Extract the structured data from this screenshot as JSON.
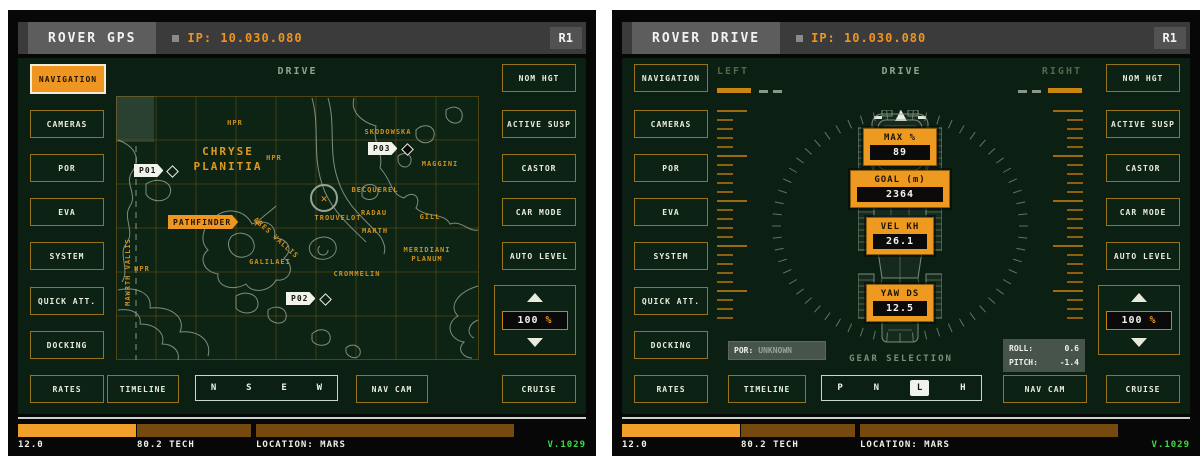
{
  "shared": {
    "ip": "IP: 10.030.080",
    "badge": "R1",
    "nav_buttons": [
      "NAVIGATION",
      "CAMERAS",
      "POR",
      "EVA",
      "SYSTEM",
      "QUICK ATT.",
      "DOCKING",
      "RATES"
    ],
    "right_buttons": [
      "NOM HGT",
      "ACTIVE SUSP",
      "CASTOR",
      "CAR MODE",
      "AUTO LEVEL"
    ],
    "speed": {
      "value": "100",
      "unit": "%"
    },
    "cruise": "CRUISE",
    "timeline": "TIMELINE",
    "nav_cam": "NAV CAM",
    "status": {
      "power": "12.0",
      "tech": "80.2 TECH",
      "location": "LOCATION: MARS",
      "version": "V.1029"
    }
  },
  "gps": {
    "title": "ROVER GPS",
    "center_header": "DRIVE",
    "compass": [
      "N",
      "S",
      "E",
      "W"
    ],
    "map": {
      "region_1": "CHRYSE",
      "region_2": "PLANITIA",
      "labels": {
        "hpr_a": "HPR",
        "hpr_b": "HPR",
        "hpr_c": "HPR",
        "skodowska": "SKODOWSKA",
        "maggini": "MAGGINI",
        "becquerel": "BECQUEREL",
        "trouvelot": "TROUVELOT",
        "radau": "RADAU",
        "gill": "GILL",
        "marth": "MARTH",
        "meridiani_1": "MERIDIANI",
        "meridiani_2": "PLANUM",
        "crommelin": "CROMMELIN",
        "galilaei": "GALILAEI",
        "ares_vallis": "ARES VALLIS",
        "mawrth_vallis": "MAWRTH VALLIS"
      },
      "waypoints": {
        "p01": "P01",
        "p02": "P02",
        "p03": "P03",
        "pathfinder": "PATHFINDER"
      },
      "x_glyph": "✕"
    }
  },
  "drive": {
    "title": "ROVER DRIVE",
    "header": {
      "left": "LEFT",
      "center": "DRIVE",
      "right": "RIGHT"
    },
    "readouts": {
      "max": {
        "label": "MAX %",
        "value": "89"
      },
      "goal": {
        "label": "GOAL (m)",
        "value": "2364"
      },
      "vel": {
        "label": "VEL KH",
        "value": "26.1"
      },
      "yaw": {
        "label": "YAW DS",
        "value": "12.5"
      }
    },
    "por": {
      "label": "POR:",
      "value": "UNKNOWN"
    },
    "gear": {
      "title": "GEAR SELECTION",
      "options": [
        "P",
        "N",
        "L",
        "H"
      ],
      "active": "L"
    },
    "attitude": {
      "roll_label": "ROLL:",
      "roll_value": "0.6",
      "pitch_label": "PITCH:",
      "pitch_value": "-1.4"
    }
  },
  "colors": {
    "accent": "#ee9a20",
    "panel_green": "#0b2013",
    "status_green": "#3bdc44"
  }
}
